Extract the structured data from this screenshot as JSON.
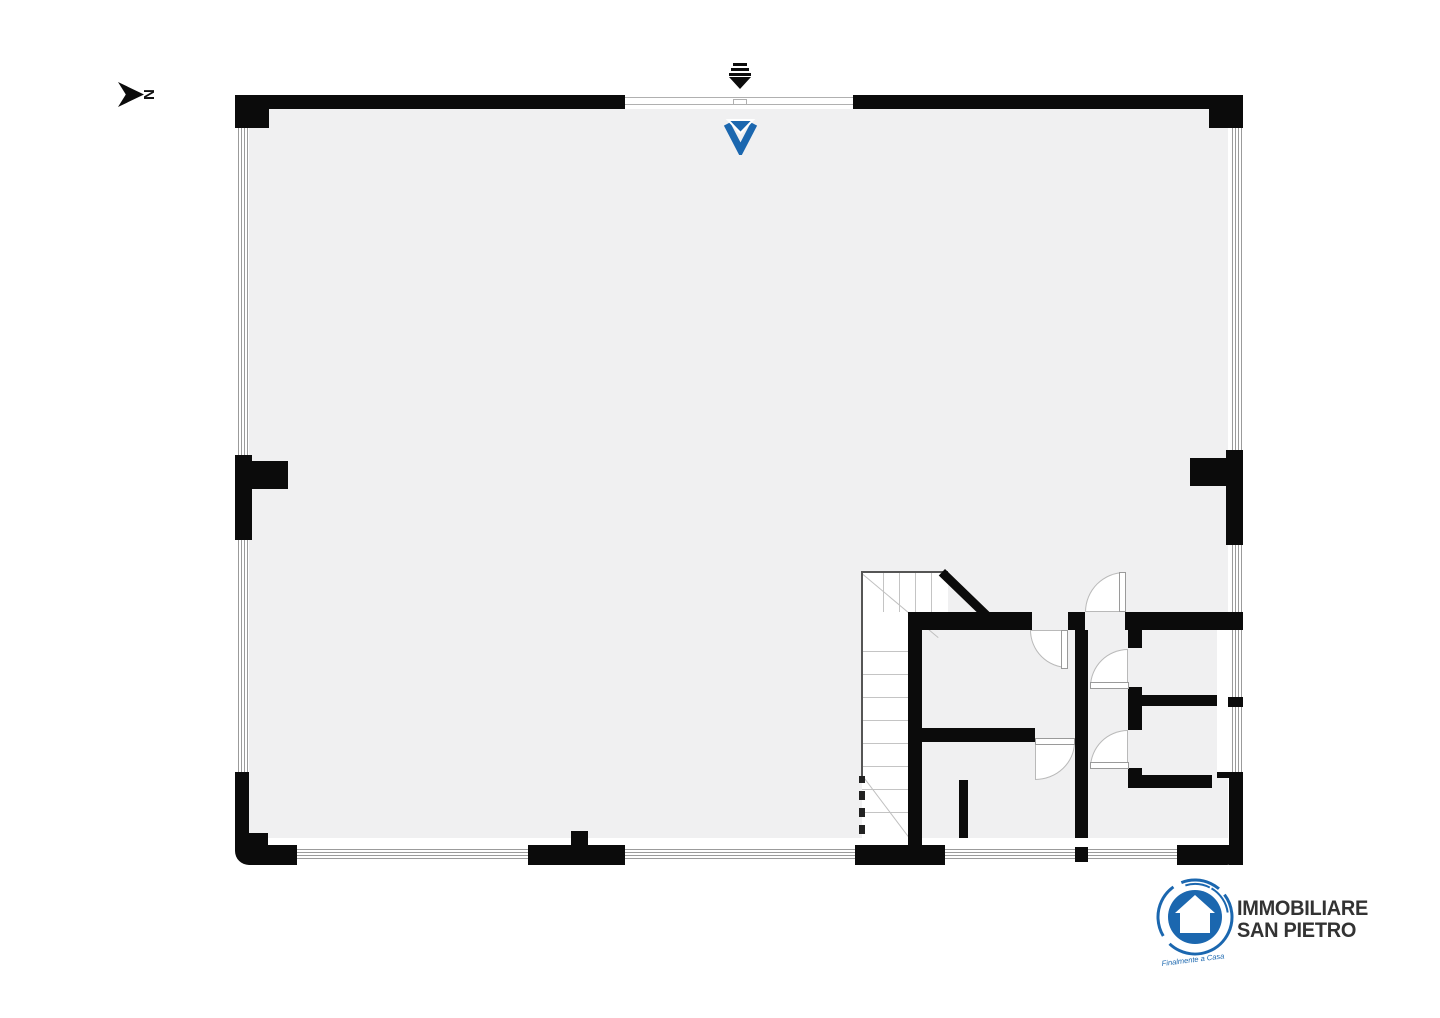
{
  "meta": {
    "background": "#ffffff",
    "floor_color": "#f0f0f1",
    "wall_color": "#0b0b0b",
    "accent_blue": "#1b67af",
    "door_arc_color": "#b9b9b9"
  },
  "compass": {
    "label": "N",
    "icon": "north-arrow-icon"
  },
  "entrance": {
    "icon": "entry-arrow-icon"
  },
  "marker": {
    "icon": "v-marker-icon",
    "color": "#1b67af"
  },
  "plan": {
    "type": "floorplan",
    "features": [
      "open-space",
      "stairwell",
      "four-rooms-bottom-right",
      "corridor",
      "five-door-swings",
      "window-bands"
    ]
  },
  "branding": {
    "logo_icon": "house-circle-logo",
    "line1": "IMMOBILIARE",
    "line2": "SAN PIETRO",
    "tagline": "Finalmente a Casa"
  }
}
